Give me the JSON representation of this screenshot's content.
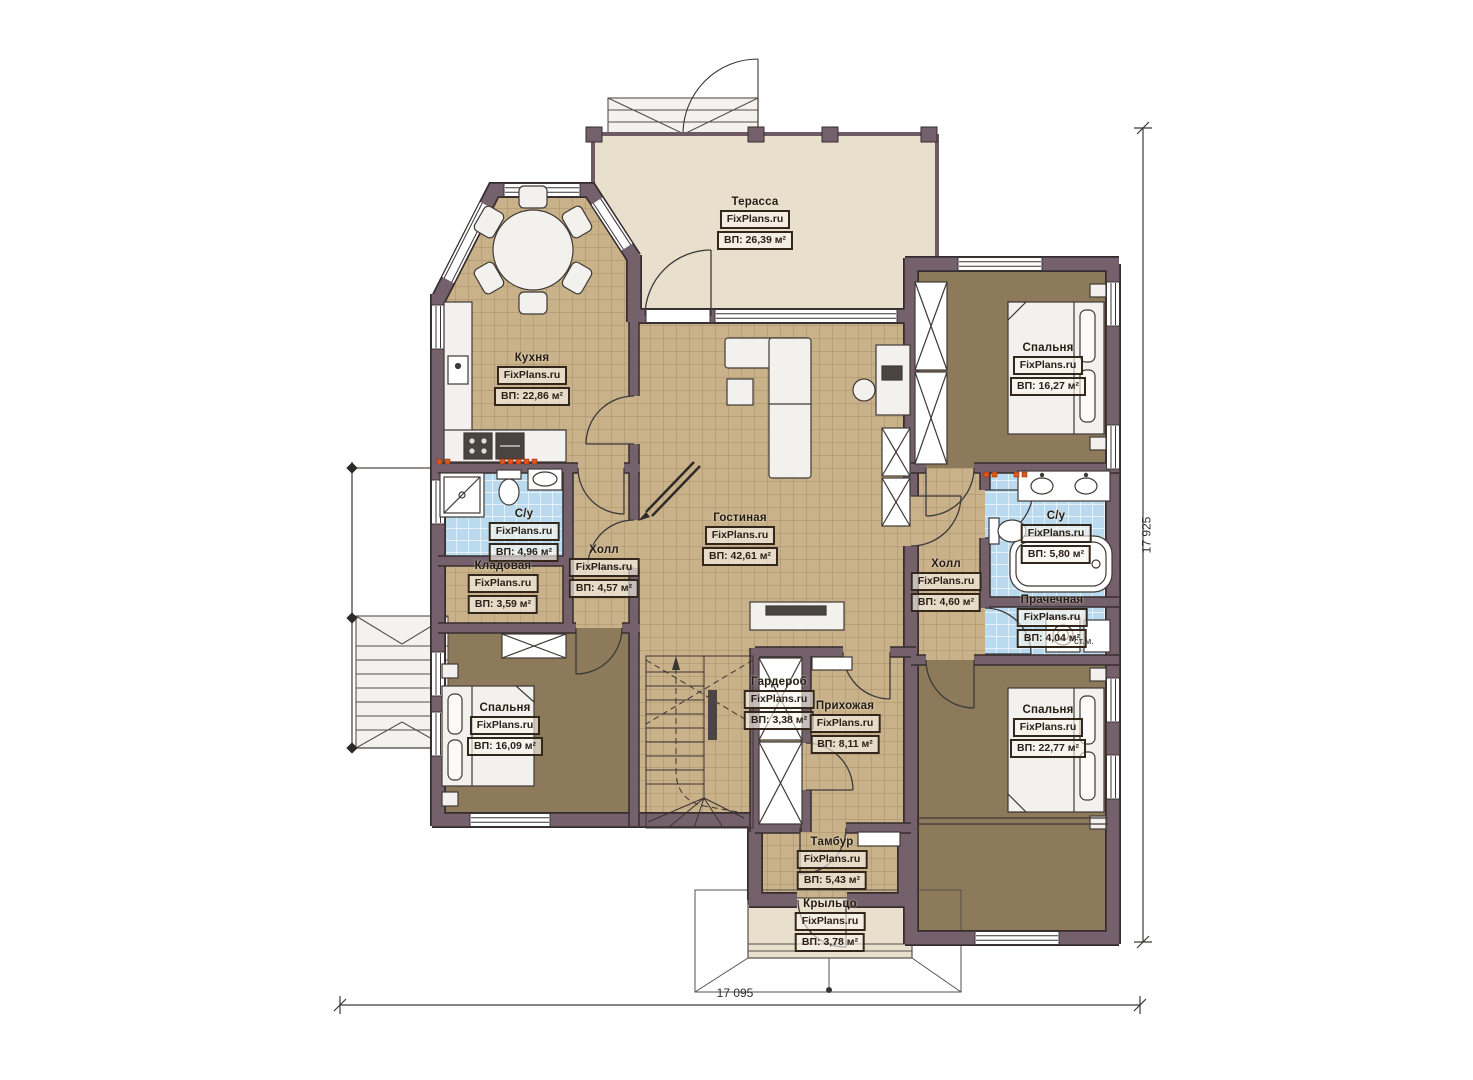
{
  "branding": {
    "site": "FixPlans.ru"
  },
  "dimensions": {
    "width": "17 095",
    "height": "17 925"
  },
  "partial_note": "ст.м.",
  "rooms": [
    {
      "id": "terrace",
      "name": "Терасса",
      "area": "ВП: 26,39 м²"
    },
    {
      "id": "kitchen",
      "name": "Кухня",
      "area": "ВП: 22,86 м²"
    },
    {
      "id": "bedroom-top-right",
      "name": "Спальня",
      "area": "ВП: 16,27 м²"
    },
    {
      "id": "living-room",
      "name": "Гостиная",
      "area": "ВП: 42,61 м²"
    },
    {
      "id": "bathroom-left",
      "name": "С/у",
      "area": "ВП: 4,96 м²"
    },
    {
      "id": "hall-left",
      "name": "Холл",
      "area": "ВП: 4,57 м²"
    },
    {
      "id": "storage",
      "name": "Кладовая",
      "area": "ВП: 3,59 м²"
    },
    {
      "id": "hall-right",
      "name": "Холл",
      "area": "ВП: 4,60 м²"
    },
    {
      "id": "bathroom-right",
      "name": "С/у",
      "area": "ВП: 5,80 м²"
    },
    {
      "id": "laundry",
      "name": "Прачечная",
      "area": "ВП: 4,04 м²"
    },
    {
      "id": "bedroom-bottom-left",
      "name": "Спальня",
      "area": "ВП: 16,09 м²"
    },
    {
      "id": "wardrobe-room",
      "name": "Гардероб",
      "area": "ВП: 3,38 м²"
    },
    {
      "id": "entry-hall",
      "name": "Прихожая",
      "area": "ВП: 8,11 м²"
    },
    {
      "id": "bedroom-bottom-right",
      "name": "Спальня",
      "area": "ВП: 22,77 м²"
    },
    {
      "id": "vestibule",
      "name": "Тамбур",
      "area": "ВП: 5,43 м²"
    },
    {
      "id": "porch",
      "name": "Крыльцо",
      "area": "ВП: 3,78 м²"
    }
  ],
  "colors": {
    "wall": "#75616b",
    "tile": "#c9b289",
    "carpet": "#8c7a5a",
    "terrace_floor": "#e9dfcd",
    "bath_tile": "#b9daef",
    "radiator": "#e2561b"
  }
}
